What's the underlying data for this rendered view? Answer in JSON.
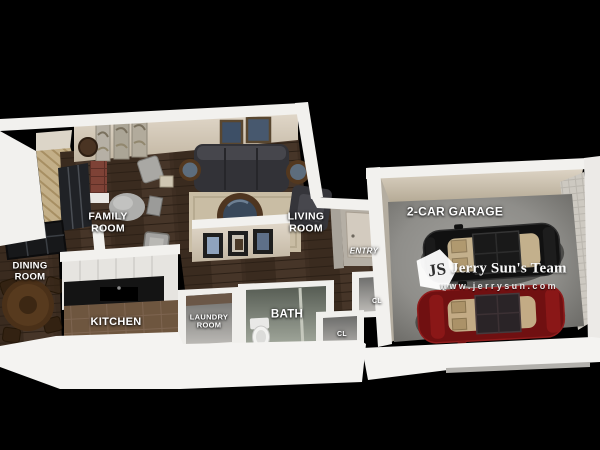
{
  "scene": {
    "description": "3D rendered apartment floor plan with attached garage on black background"
  },
  "rooms": {
    "family": {
      "line1": "FAMILY",
      "line2": "ROOM"
    },
    "living": {
      "line1": "LIVING",
      "line2": "ROOM"
    },
    "dining": {
      "line1": "DINING",
      "line2": "ROOM"
    },
    "kitchen": {
      "label": "KITCHEN"
    },
    "laundry": {
      "line1": "LAUNDRY",
      "line2": "ROOM"
    },
    "bath": {
      "label": "BATH"
    },
    "entry": {
      "label": "ENTRY"
    },
    "closet_upper": {
      "label": "CL"
    },
    "closet_lower": {
      "label": "CL"
    },
    "garage": {
      "label": "2-CAR GARAGE"
    }
  },
  "watermark": {
    "logo_monogram": "JS",
    "team_name": "Jerry Sun's Team",
    "website": "www.jerrysun.com"
  },
  "colors": {
    "background": "#000000",
    "wall_white": "#f2f1ee",
    "wall_beige": "#d4c9b8",
    "wood_floor": "#3f2f23",
    "concrete": "#8f8e8a",
    "car_black": "#141414",
    "car_red": "#701011",
    "rug": "#c9bda4"
  }
}
